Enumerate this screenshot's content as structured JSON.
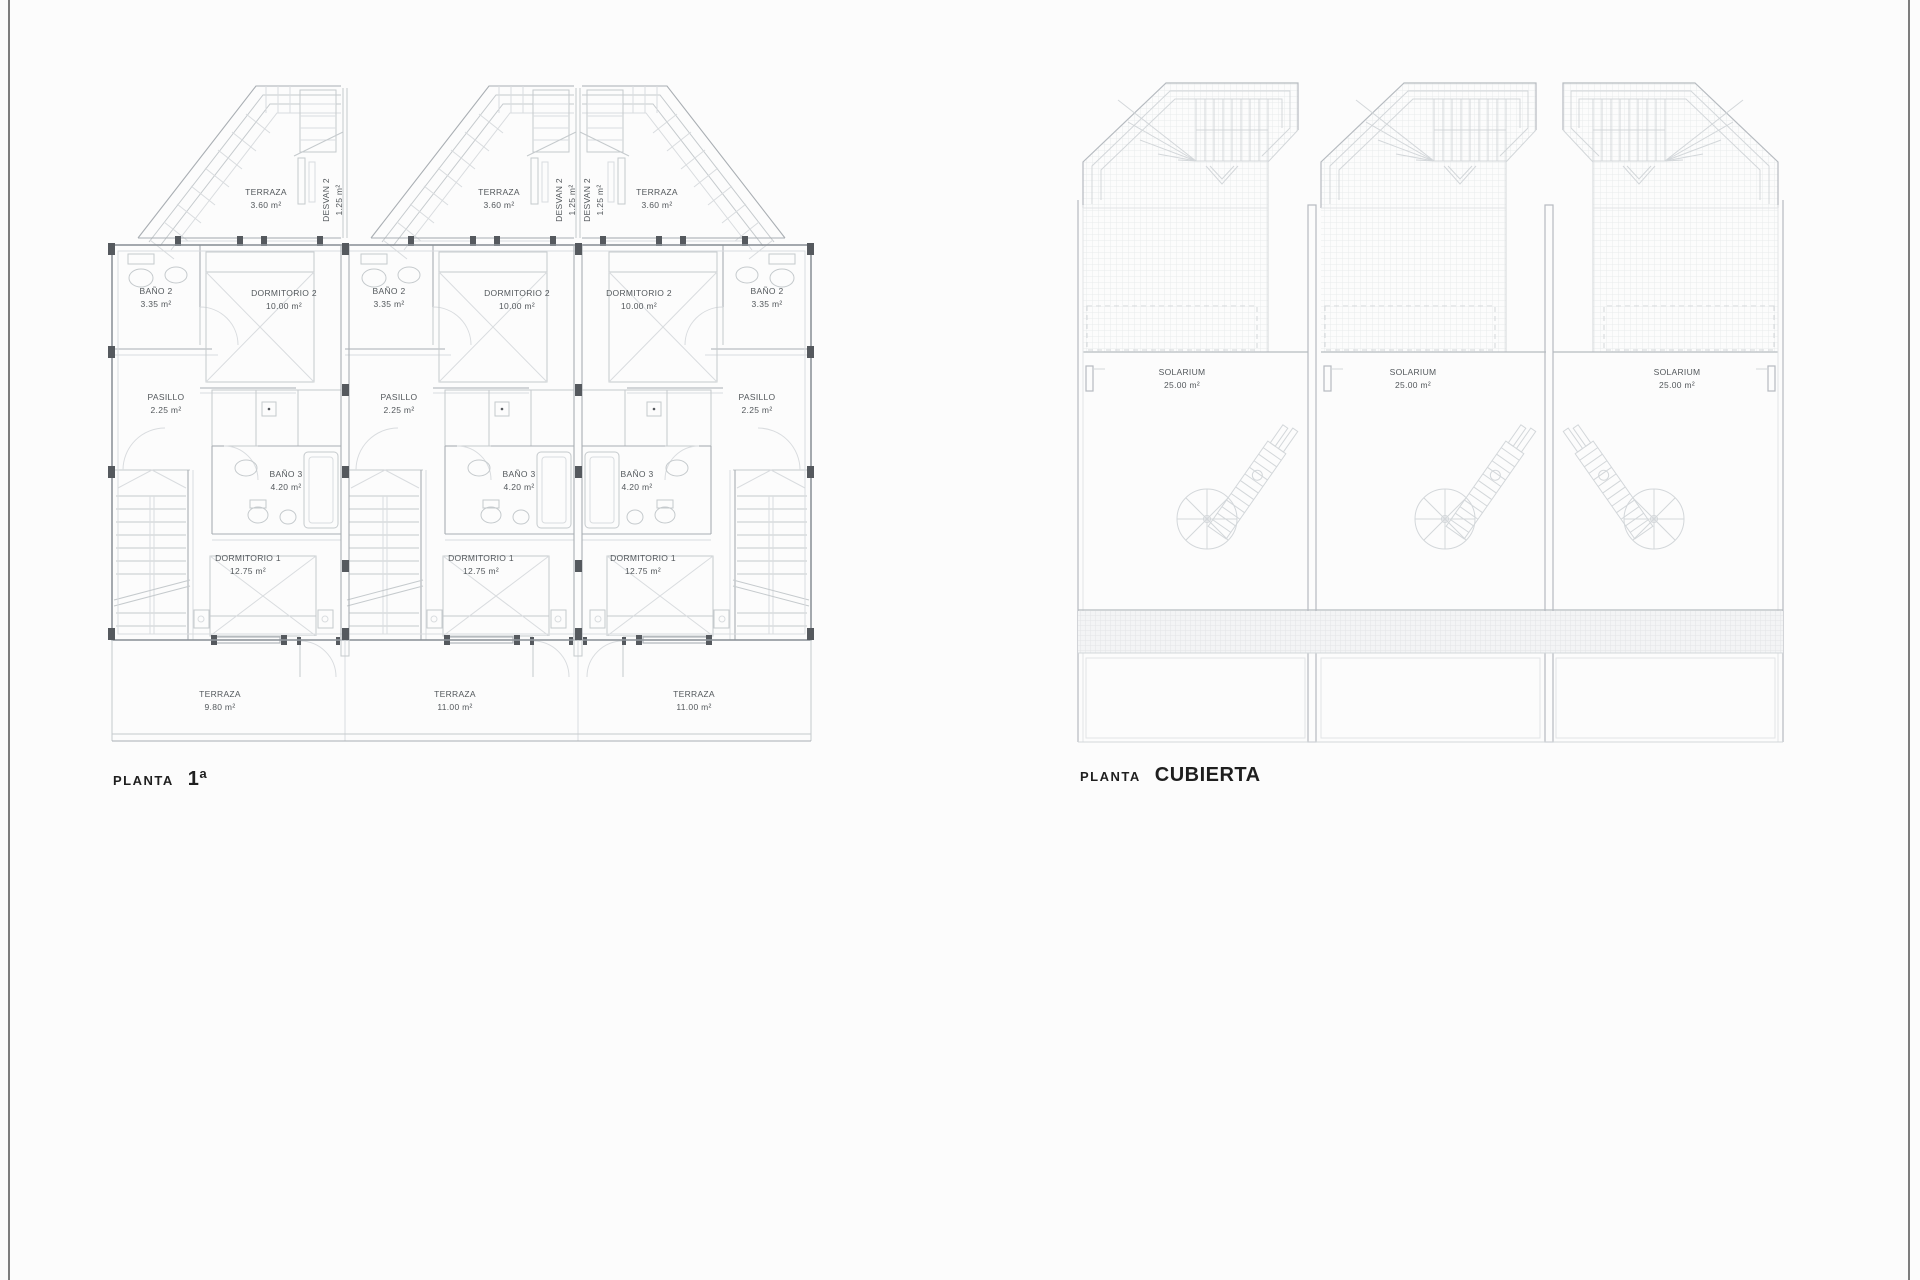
{
  "palette": {
    "background": "#fcfcfc",
    "page_frame": "#7d7d7d",
    "walls": "#8e949a",
    "linework": "#aab0b5",
    "labels": "#53585c",
    "titles": "#1f1f1f"
  },
  "plan1": {
    "title_label": "PLANTA",
    "title_value": "1ª",
    "units": [
      {
        "attic_terraza": {
          "name": "TERRAZA",
          "area": "3.60 m²"
        },
        "desvan": {
          "name": "DESVAN 2",
          "area": "1.25 m²"
        },
        "bano2": {
          "name": "BAÑO 2",
          "area": "3.35 m²"
        },
        "dormitorio2": {
          "name": "DORMITORIO 2",
          "area": "10.00 m²"
        },
        "pasillo": {
          "name": "PASILLO",
          "area": "2.25 m²"
        },
        "bano3": {
          "name": "BAÑO 3",
          "area": "4.20 m²"
        },
        "dormitorio1": {
          "name": "DORMITORIO 1",
          "area": "12.75 m²"
        },
        "terraza": {
          "name": "TERRAZA",
          "area": "9.80 m²"
        }
      },
      {
        "attic_terraza": {
          "name": "TERRAZA",
          "area": "3.60 m²"
        },
        "desvan": {
          "name": "DESVAN 2",
          "area": "1.25 m²"
        },
        "bano2": {
          "name": "BAÑO 2",
          "area": "3.35 m²"
        },
        "dormitorio2": {
          "name": "DORMITORIO 2",
          "area": "10.00 m²"
        },
        "pasillo": {
          "name": "PASILLO",
          "area": "2.25 m²"
        },
        "bano3": {
          "name": "BAÑO 3",
          "area": "4.20 m²"
        },
        "dormitorio1": {
          "name": "DORMITORIO 1",
          "area": "12.75 m²"
        },
        "terraza": {
          "name": "TERRAZA",
          "area": "11.00 m²"
        }
      },
      {
        "attic_terraza": {
          "name": "TERRAZA",
          "area": "3.60 m²"
        },
        "desvan": {
          "name": "DESVAN 2",
          "area": "1.25 m²"
        },
        "bano2": {
          "name": "BAÑO 2",
          "area": "3.35 m²"
        },
        "dormitorio2": {
          "name": "DORMITORIO 2",
          "area": "10.00 m²"
        },
        "pasillo": {
          "name": "PASILLO",
          "area": "2.25 m²"
        },
        "bano3": {
          "name": "BAÑO 3",
          "area": "4.20 m²"
        },
        "dormitorio1": {
          "name": "DORMITORIO 1",
          "area": "12.75 m²"
        },
        "terraza": {
          "name": "TERRAZA",
          "area": "11.00 m²"
        }
      }
    ]
  },
  "plan2": {
    "title_label": "PLANTA",
    "title_value": "CUBIERTA",
    "units": [
      {
        "solarium": {
          "name": "SOLARIUM",
          "area": "25.00 m²"
        }
      },
      {
        "solarium": {
          "name": "SOLARIUM",
          "area": "25.00 m²"
        }
      },
      {
        "solarium": {
          "name": "SOLARIUM",
          "area": "25.00 m²"
        }
      }
    ]
  }
}
